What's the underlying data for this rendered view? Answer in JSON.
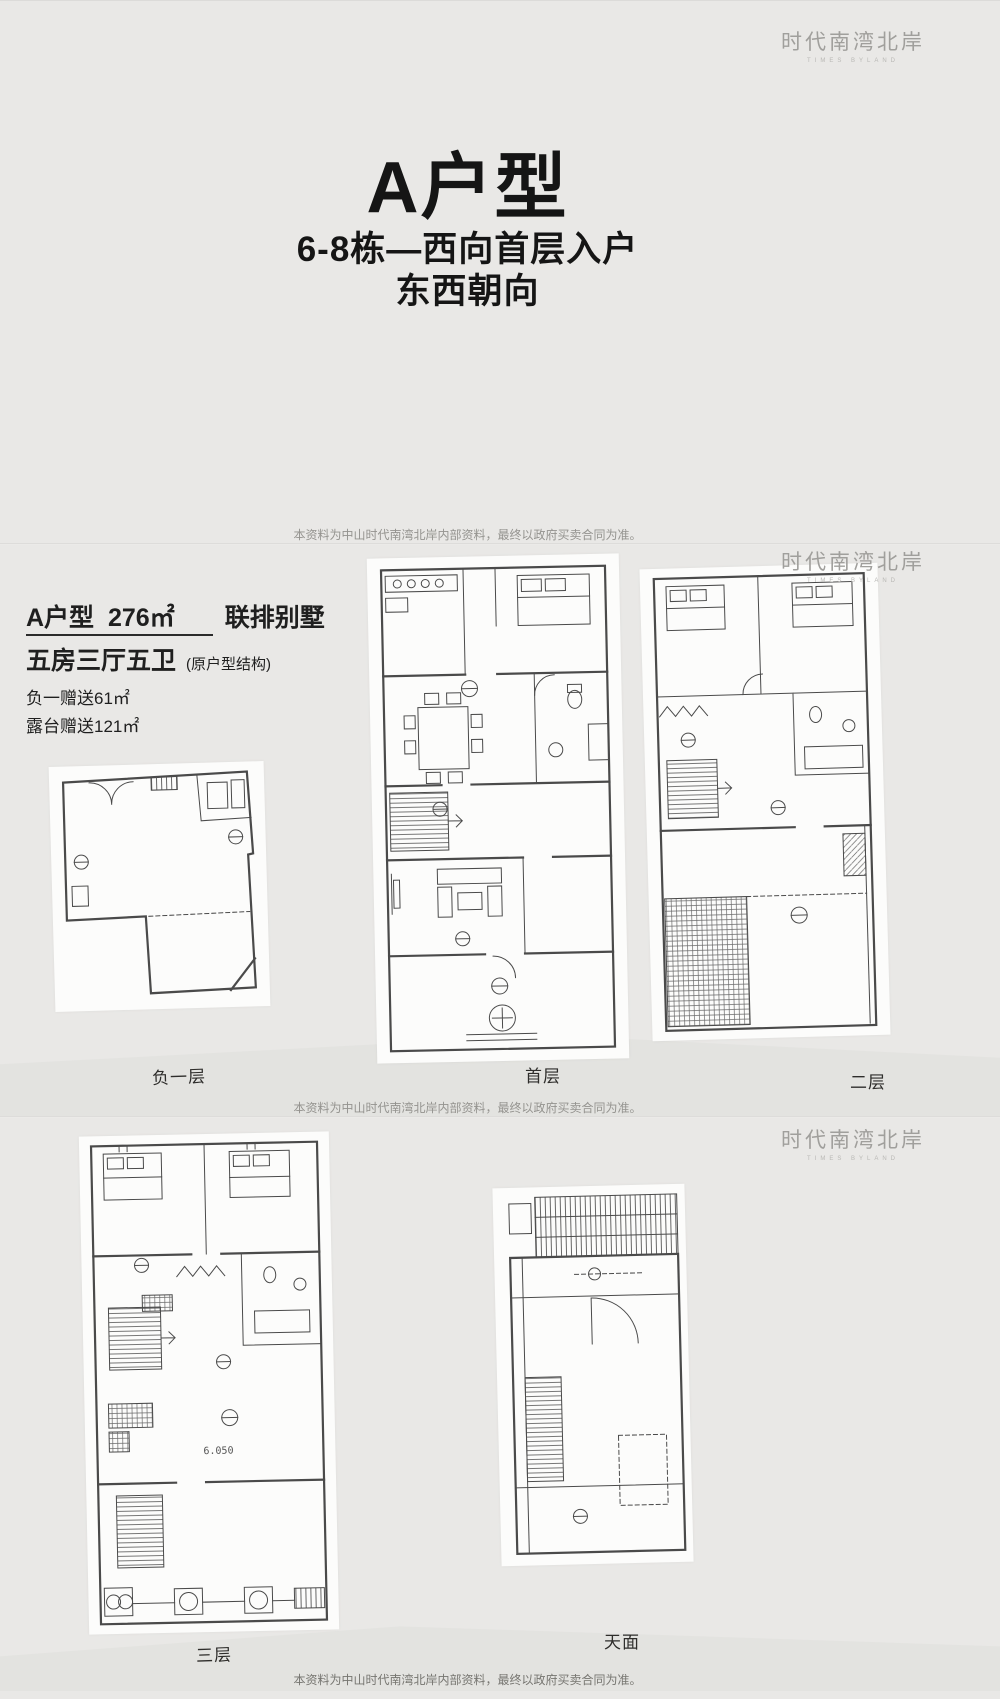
{
  "logo": {
    "name_cn": "时代南湾北岸",
    "name_en": "TIMES BYLAND"
  },
  "colors": {
    "page_bg": "#e9e8e6",
    "title_text": "#151515",
    "logo_gray": "#a09f9c",
    "plan_line": "#4a4a4a",
    "sheet_bg": "#fcfcfb"
  },
  "panel_top": {
    "title": "A户型",
    "subtitle_line1": "6-8栋—西向首层入户",
    "subtitle_line2": "东西朝向",
    "disclaimer": "本资料为中山时代南湾北岸内部资料，最终以政府买卖合同为准。"
  },
  "panel_middle": {
    "unit_name": "A户型",
    "unit_area": "276㎡",
    "unit_type": "联排别墅",
    "rooms": "五房三厅五卫",
    "rooms_note": "(原户型结构)",
    "bonus_basement": "负一赠送61㎡",
    "bonus_terrace": "露台赠送121㎡",
    "plan_labels": [
      "负一层",
      "首层",
      "二层"
    ],
    "disclaimer": "本资料为中山时代南湾北岸内部资料，最终以政府买卖合同为准。"
  },
  "panel_bottom": {
    "plan_labels": [
      "三层",
      "天面"
    ],
    "level_mark": "6.050",
    "disclaimer": "本资料为中山时代南湾北岸内部资料，最终以政府买卖合同为准。"
  }
}
